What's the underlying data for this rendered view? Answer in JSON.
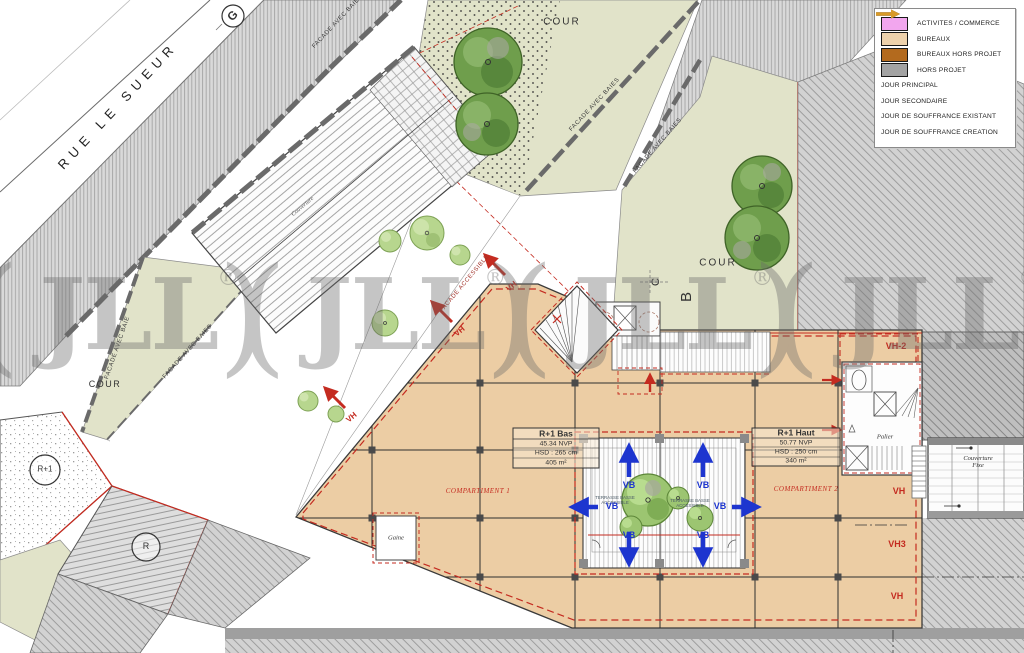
{
  "street": {
    "name": "RUE LE SUEUR"
  },
  "markers": {
    "g": "G",
    "r1": "R+1",
    "r": "R",
    "c": "C",
    "b": "B"
  },
  "courtyards": {
    "top": "COUR",
    "right": "COUR",
    "left": "COUR"
  },
  "facades": {
    "avec_baie": "FACADE AVEC BAIE",
    "avec_baies": "FACADE AVEC BAIES",
    "accessible": "FACADE ACCESSIBLE"
  },
  "units": {
    "r1_bas": {
      "title": "R+1 Bas",
      "nvp": "45.34 NVP",
      "hsd": "HSD : 265 cm",
      "area": "405 m²"
    },
    "r1_haut": {
      "title": "R+1 Haut",
      "nvp": "50.77 NVP",
      "hsd": "HSD : 250 cm",
      "area": "340 m²"
    }
  },
  "zones": {
    "compartiment1": "COMPARTIMENT 1",
    "compartiment2": "COMPARTIMENT 2",
    "gaine": "Gaine",
    "palier": "Palier",
    "couverture": "Couverture",
    "couverture_fixe_l1": "Couverture",
    "couverture_fixe_l2": "Fixe",
    "terrasse_l1": "TERRASSE BASSE",
    "terrasse_l2": "ACCESSIBLE"
  },
  "annotations": {
    "vb": "VB",
    "vh": "VH",
    "vh2": "VH-2",
    "vh3": "VH3"
  },
  "watermark": {
    "mark": "()",
    "text": "JLL",
    "reg": "®"
  },
  "legend": {
    "items": [
      {
        "type": "swatch",
        "color": "#f2a6ee",
        "label": "ACTIVITES / COMMERCE"
      },
      {
        "type": "swatch",
        "color": "#eed2ac",
        "label": "BUREAUX"
      },
      {
        "type": "swatch",
        "color": "#b36a1e",
        "label": "BUREAUX HORS PROJET"
      },
      {
        "type": "swatch",
        "color": "#a3a3a3",
        "label": "HORS PROJET"
      },
      {
        "type": "arrow",
        "color": "#1d35cf",
        "label": "JOUR PRINCIPAL"
      },
      {
        "type": "arrow",
        "color": "#d963cc",
        "label": "JOUR SECONDAIRE"
      },
      {
        "type": "arrow",
        "color": "#6f9a2f",
        "label": "JOUR DE SOUFFRANCE EXISTANT"
      },
      {
        "type": "arrow",
        "color": "#d89a28",
        "label": "JOUR DE SOUFFRANCE CREATION"
      }
    ]
  },
  "colors": {
    "bureaux": "#eccda4",
    "cour": "#e1e3c9",
    "hors_projet_hatch": "#d2d2d2",
    "annotation_red": "#c42b20",
    "jour_principal_blue": "#1d35cf"
  }
}
